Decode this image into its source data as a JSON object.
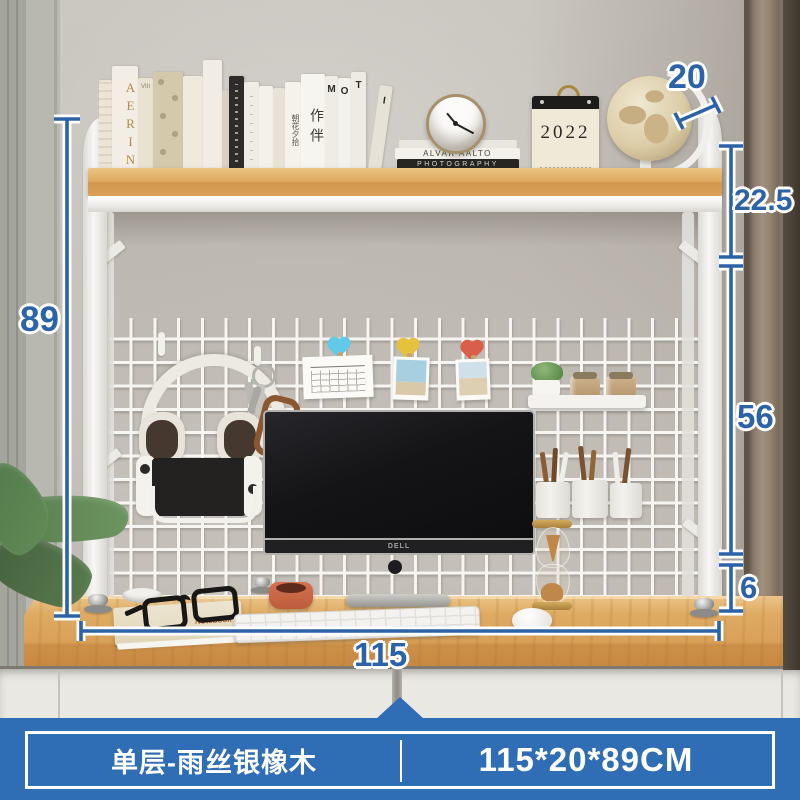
{
  "product": {
    "variant_label": "单层-雨丝银橡木",
    "size_label": "115*20*89CM"
  },
  "dimensions": {
    "width_cm": "115",
    "depth_cm": "20",
    "height_cm": "89",
    "upper_clearance_cm": "22.5",
    "middle_clearance_cm": "56",
    "foot_height_cm": "6"
  },
  "decor": {
    "book_aerin": "AERIN",
    "book_viii": "VIII",
    "book_chaohua": "朝花夕拾",
    "book_zuoban": "作伴",
    "book_m": "M",
    "book_o": "O",
    "book_t": "T",
    "book_i": "I",
    "stack_book_top": "ALVAR AALTO",
    "stack_book_bottom": "PHOTOGRAPHY",
    "calendar_year": "2022",
    "monitor_brand": "DELL",
    "notebook_label": "Notebook"
  },
  "colors": {
    "dimension_blue": "#2b62a8",
    "banner_blue": "#2f6db4",
    "shelf_wood": "#d9a058",
    "frame_white": "#f3f2ef",
    "curtain_brown": "#85766a",
    "drawer_white": "#eae8e3",
    "heart_clip_blue": "#62c9e6",
    "heart_clip_yellow": "#e4c23e",
    "heart_clip_red": "#d95f4a"
  }
}
